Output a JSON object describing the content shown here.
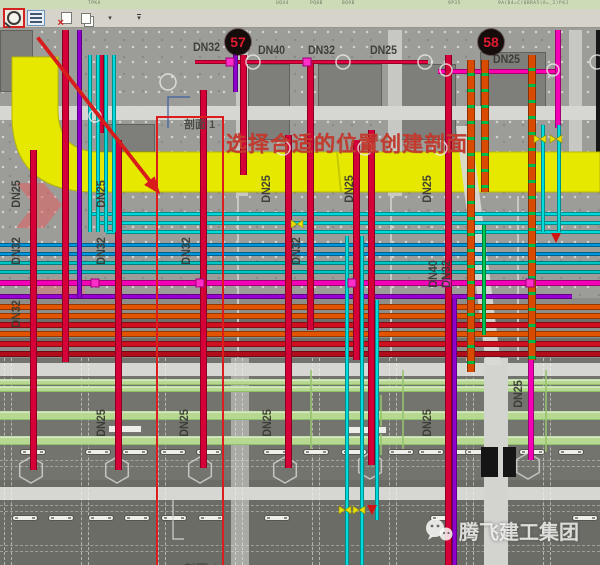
{
  "ribbon": {
    "fragments": [
      {
        "text": "TPKA",
        "x": 88
      },
      {
        "text": "UQ44",
        "x": 276
      },
      {
        "text": "PQ8B",
        "x": 310
      },
      {
        "text": "BQ9B",
        "x": 342
      },
      {
        "text": "9P35",
        "x": 448
      },
      {
        "text": "9A(D4=C(QBRA5(A=_2)P4J",
        "x": 498
      }
    ]
  },
  "toolbar": {
    "buttons": [
      {
        "name": "reveal-hidden-elements"
      },
      {
        "name": "visibility-graphics"
      },
      {
        "name": "close-hidden-windows"
      },
      {
        "name": "switch-windows"
      },
      {
        "name": "windows-dropdown"
      },
      {
        "name": "toolbar-overflow"
      }
    ]
  },
  "annotations": {
    "tip_text": "选择合适的位置创建剖面",
    "section_label_top": "剖面 1",
    "section_label_bottom": "剖面 1",
    "marker_left": "57",
    "marker_right": "58"
  },
  "watermark": {
    "text": "腾飞建工集团"
  },
  "pipe_labels_h": [
    {
      "t": "DN32",
      "x": 193,
      "y": 40
    },
    {
      "t": "DN40",
      "x": 258,
      "y": 43
    },
    {
      "t": "DN32",
      "x": 308,
      "y": 43
    },
    {
      "t": "DN25",
      "x": 370,
      "y": 43
    },
    {
      "t": "DN25",
      "x": 493,
      "y": 52
    }
  ],
  "pipe_labels_v": [
    {
      "t": "DN25",
      "x": 16,
      "y": 195
    },
    {
      "t": "DN25",
      "x": 101,
      "y": 195
    },
    {
      "t": "DN25",
      "x": 266,
      "y": 190
    },
    {
      "t": "DN25",
      "x": 349,
      "y": 190
    },
    {
      "t": "DN25",
      "x": 427,
      "y": 190
    },
    {
      "t": "DN32",
      "x": 16,
      "y": 252
    },
    {
      "t": "DN32",
      "x": 101,
      "y": 252
    },
    {
      "t": "DN32",
      "x": 186,
      "y": 252
    },
    {
      "t": "DN32",
      "x": 296,
      "y": 252
    },
    {
      "t": "DN32",
      "x": 16,
      "y": 315
    },
    {
      "t": "DN40",
      "x": 433,
      "y": 275
    },
    {
      "t": "DN32",
      "x": 446,
      "y": 275
    },
    {
      "t": "DN25",
      "x": 101,
      "y": 424
    },
    {
      "t": "DN25",
      "x": 184,
      "y": 424
    },
    {
      "t": "DN25",
      "x": 267,
      "y": 424
    },
    {
      "t": "DN25",
      "x": 427,
      "y": 424
    },
    {
      "t": "DN25",
      "x": 518,
      "y": 395
    }
  ],
  "colors": {
    "annotation_red": "#dd1d1d",
    "duct_yellow": "#e6e800",
    "sprinkler_red": "#d50037",
    "chilled_cyan": "#00d9d9",
    "drain_orange": "#e25400",
    "marker_bg": "#150c0c",
    "marker_text": "#e31b30"
  },
  "drawing": {
    "zones": [
      {
        "x": 0,
        "y": 298,
        "w": 600,
        "h": 62,
        "c": "#8d8d8a"
      },
      {
        "x": 0,
        "y": 318,
        "w": 600,
        "h": 5,
        "c": "#6f6f6b"
      },
      {
        "x": 0,
        "y": 338,
        "w": 600,
        "h": 5,
        "c": "#6f6f6b"
      },
      {
        "x": 0,
        "y": 358,
        "w": 600,
        "h": 124,
        "c": "#74746f"
      },
      {
        "x": 0,
        "y": 480,
        "w": 600,
        "h": 85,
        "c": "#6c6c67"
      }
    ],
    "panels": [
      {
        "x": 0,
        "y": 30,
        "w": 33,
        "h": 62
      },
      {
        "x": 248,
        "y": 64,
        "w": 42,
        "h": 76
      },
      {
        "x": 318,
        "y": 64,
        "w": 64,
        "h": 54
      },
      {
        "x": 398,
        "y": 64,
        "w": 58,
        "h": 76
      },
      {
        "x": 480,
        "y": 52,
        "w": 66,
        "h": 64
      },
      {
        "x": 97,
        "y": 124,
        "w": 58,
        "h": 28
      }
    ],
    "strips": [
      {
        "x": 236,
        "y": 30,
        "w": 12,
        "h": 166
      },
      {
        "x": 388,
        "y": 30,
        "w": 14,
        "h": 166
      },
      {
        "x": 569,
        "y": 30,
        "w": 13,
        "h": 158
      },
      {
        "x": 237,
        "y": 196,
        "w": 2,
        "h": 162
      },
      {
        "x": 390,
        "y": 196,
        "w": 2,
        "h": 162
      },
      {
        "x": 517,
        "y": 196,
        "w": 2,
        "h": 164
      },
      {
        "x": 231,
        "y": 358,
        "w": 18,
        "h": 207,
        "c": "#a9a9a5"
      }
    ],
    "bands": [
      {
        "x": 0,
        "y": 106,
        "w": 600,
        "h": 14
      },
      {
        "x": 0,
        "y": 363,
        "w": 600,
        "h": 13
      },
      {
        "x": 0,
        "y": 487,
        "w": 600,
        "h": 13
      }
    ],
    "grid_v": [
      4,
      81,
      158,
      235,
      312,
      389,
      466,
      543
    ],
    "grid_h": [
      460,
      505,
      545
    ],
    "green_bands": [
      {
        "y": 379,
        "h": 6
      },
      {
        "y": 386,
        "h": 6
      },
      {
        "y": 411,
        "h": 9
      },
      {
        "y": 436,
        "h": 9
      }
    ],
    "green_v": [
      {
        "x": 310,
        "y": 370,
        "h": 85
      },
      {
        "x": 380,
        "y": 395,
        "h": 60
      },
      {
        "x": 402,
        "y": 370,
        "h": 85
      },
      {
        "x": 545,
        "y": 370,
        "h": 82
      }
    ],
    "corridor": {
      "x": 484,
      "y": 358,
      "w": 24,
      "h": 207
    },
    "fixtures": [
      {
        "y": 449,
        "xs": [
          20,
          85,
          122,
          160,
          196,
          263,
          303,
          341,
          388,
          418,
          450,
          465,
          519,
          558
        ]
      },
      {
        "y": 515,
        "xs": [
          12,
          48,
          88,
          124,
          161,
          198,
          264,
          430,
          572
        ]
      }
    ],
    "hexes": [
      [
        31,
        470
      ],
      [
        117,
        470
      ],
      [
        200,
        470
      ],
      [
        285,
        470
      ],
      [
        370,
        466
      ],
      [
        528,
        466
      ]
    ],
    "black_rects": [
      {
        "x": 481,
        "y": 447,
        "w": 17,
        "h": 30
      },
      {
        "x": 503,
        "y": 447,
        "w": 13,
        "h": 30
      }
    ],
    "white_bars": [
      {
        "x": 108,
        "y": 425,
        "w": 32,
        "h": 6
      },
      {
        "x": 347,
        "y": 426,
        "w": 38,
        "h": 6
      }
    ],
    "h_pipes": [
      {
        "x": 195,
        "y": 60,
        "w": 233,
        "h": 4,
        "c": "#e60040"
      },
      {
        "x": 438,
        "y": 69,
        "w": 119,
        "h": 5,
        "c": "#ff00ae"
      },
      {
        "x": 90,
        "y": 212,
        "w": 510,
        "h": 4,
        "c": "#00d9d9"
      },
      {
        "x": 98,
        "y": 221,
        "w": 502,
        "h": 4,
        "c": "#00d9d9"
      },
      {
        "x": 106,
        "y": 230,
        "w": 494,
        "h": 4,
        "c": "#00d9d9"
      },
      {
        "x": 0,
        "y": 243,
        "w": 600,
        "h": 4,
        "c": "#0096dc"
      },
      {
        "x": 0,
        "y": 252,
        "w": 600,
        "h": 4,
        "c": "#0096dc"
      },
      {
        "x": 0,
        "y": 261,
        "w": 600,
        "h": 4,
        "c": "#00c4c4"
      },
      {
        "x": 0,
        "y": 270,
        "w": 600,
        "h": 4,
        "c": "#00c4c4"
      },
      {
        "x": 0,
        "y": 280,
        "w": 600,
        "h": 6,
        "c": "#f400b6"
      },
      {
        "x": 0,
        "y": 294,
        "w": 572,
        "h": 5,
        "c": "#9a00d2"
      },
      {
        "x": 0,
        "y": 304,
        "w": 600,
        "h": 6,
        "c": "#e25400"
      },
      {
        "x": 0,
        "y": 313,
        "w": 600,
        "h": 6,
        "c": "#e25400"
      },
      {
        "x": 0,
        "y": 322,
        "w": 600,
        "h": 6,
        "c": "#cf1020"
      },
      {
        "x": 0,
        "y": 331,
        "w": 600,
        "h": 6,
        "c": "#e25400"
      },
      {
        "x": 0,
        "y": 341,
        "w": 600,
        "h": 6,
        "c": "#cf1020"
      },
      {
        "x": 0,
        "y": 351,
        "w": 600,
        "h": 6,
        "c": "#b00d1c"
      }
    ],
    "v_pipes": [
      {
        "x": 30,
        "y": 150,
        "h": 320,
        "w": 7,
        "c": "#d50037"
      },
      {
        "x": 62,
        "y": 30,
        "h": 332,
        "w": 7,
        "c": "#d50037"
      },
      {
        "x": 97,
        "y": 55,
        "h": 78,
        "w": 7,
        "c": "#d50037"
      },
      {
        "x": 115,
        "y": 140,
        "h": 330,
        "w": 7,
        "c": "#d50037"
      },
      {
        "x": 200,
        "y": 90,
        "h": 378,
        "w": 7,
        "c": "#d50037"
      },
      {
        "x": 240,
        "y": 55,
        "h": 120,
        "w": 7,
        "c": "#d50037"
      },
      {
        "x": 285,
        "y": 135,
        "h": 333,
        "w": 7,
        "c": "#d50037"
      },
      {
        "x": 307,
        "y": 62,
        "h": 268,
        "w": 7,
        "c": "#d50037"
      },
      {
        "x": 353,
        "y": 140,
        "h": 220,
        "w": 7,
        "c": "#d50037"
      },
      {
        "x": 368,
        "y": 130,
        "h": 335,
        "w": 7,
        "c": "#d50037"
      },
      {
        "x": 445,
        "y": 55,
        "h": 510,
        "w": 7,
        "c": "#d50037"
      },
      {
        "x": 467,
        "y": 60,
        "h": 312,
        "w": 8,
        "t": "o"
      },
      {
        "x": 481,
        "y": 60,
        "h": 132,
        "w": 8,
        "t": "o"
      },
      {
        "x": 528,
        "y": 55,
        "h": 305,
        "w": 8,
        "t": "o"
      },
      {
        "x": 528,
        "y": 360,
        "h": 100,
        "w": 6,
        "c": "#f400b6"
      },
      {
        "x": 555,
        "y": 30,
        "h": 98,
        "w": 6,
        "c": "#f400b6"
      },
      {
        "x": 77,
        "y": 30,
        "h": 268,
        "w": 5,
        "c": "#8f00cc"
      },
      {
        "x": 233,
        "y": 30,
        "h": 62,
        "w": 5,
        "c": "#8f00cc"
      },
      {
        "x": 452,
        "y": 298,
        "h": 267,
        "w": 5,
        "c": "#8f00cc"
      },
      {
        "x": 88,
        "y": 55,
        "h": 177,
        "w": 4,
        "c": "#00dcdc"
      },
      {
        "x": 96,
        "y": 55,
        "h": 177,
        "w": 4,
        "c": "#00dcdc"
      },
      {
        "x": 104,
        "y": 55,
        "h": 177,
        "w": 4,
        "c": "#00dcdc"
      },
      {
        "x": 112,
        "y": 55,
        "h": 177,
        "w": 4,
        "c": "#00dcdc"
      },
      {
        "x": 345,
        "y": 236,
        "h": 329,
        "w": 4,
        "c": "#00dcdc"
      },
      {
        "x": 360,
        "y": 236,
        "h": 329,
        "w": 4,
        "c": "#00dcdc"
      },
      {
        "x": 375,
        "y": 300,
        "h": 220,
        "w": 4,
        "c": "#00dcdc"
      },
      {
        "x": 541,
        "y": 125,
        "h": 107,
        "w": 4,
        "c": "#00dcdc"
      },
      {
        "x": 557,
        "y": 125,
        "h": 107,
        "w": 4,
        "c": "#00dcdc"
      },
      {
        "x": 482,
        "y": 225,
        "h": 110,
        "w": 4,
        "c": "#00c853"
      }
    ],
    "circles": [
      [
        253,
        62,
        7
      ],
      [
        343,
        62,
        7
      ],
      [
        425,
        62,
        7
      ],
      [
        597,
        62,
        7
      ],
      [
        446,
        70,
        6
      ],
      [
        553,
        70,
        6
      ],
      [
        168,
        82,
        8
      ],
      [
        95,
        116,
        6
      ],
      [
        283,
        148,
        7
      ],
      [
        365,
        148,
        7
      ],
      [
        440,
        148,
        7
      ]
    ],
    "nodes": [
      [
        230,
        62
      ],
      [
        307,
        62
      ],
      [
        95,
        283
      ],
      [
        200,
        283
      ],
      [
        352,
        283
      ],
      [
        447,
        283
      ],
      [
        530,
        283
      ]
    ],
    "valves": [
      [
        540,
        139
      ],
      [
        556,
        139
      ],
      [
        297,
        224
      ],
      [
        345,
        510
      ],
      [
        359,
        510
      ]
    ],
    "red_syms": [
      [
        556,
        238
      ],
      [
        372,
        510
      ]
    ],
    "edge": {
      "x": 596,
      "y": 30,
      "w": 4,
      "h": 160
    }
  }
}
